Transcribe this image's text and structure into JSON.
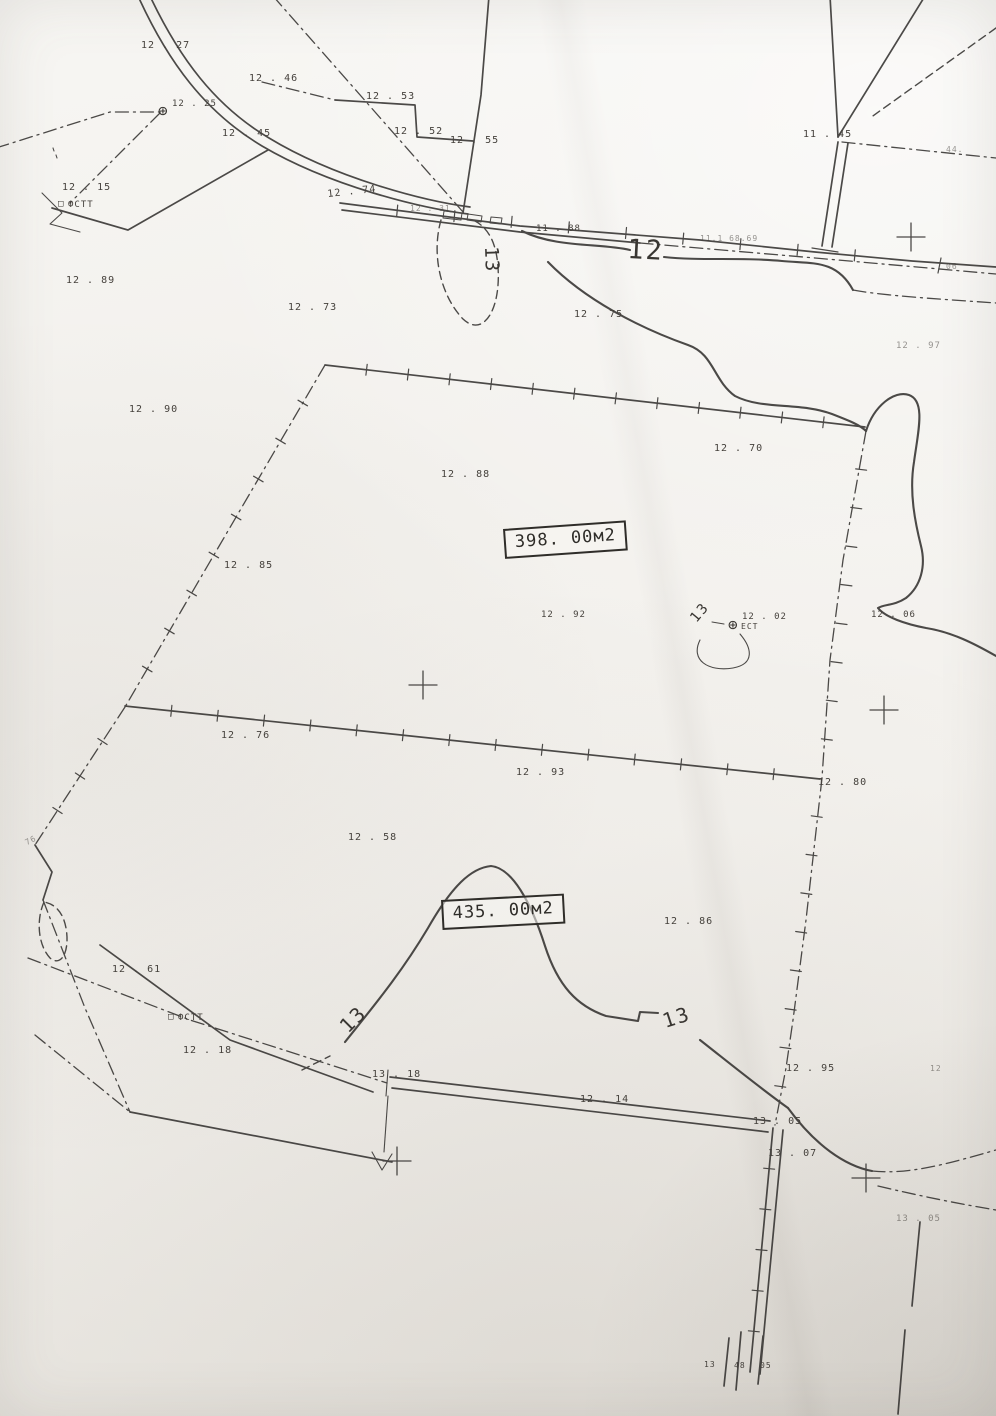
{
  "map": {
    "parcel_boxes": [
      {
        "label": "398. 00м2",
        "x": 503,
        "y": 529,
        "rot": -4
      },
      {
        "label": "435. 00м2",
        "x": 441,
        "y": 900,
        "rot": -3
      }
    ],
    "contour_labels": [
      {
        "text": "12",
        "x": 628,
        "y": 236,
        "size": 27,
        "rot": 3
      },
      {
        "text": "13",
        "x": 500,
        "y": 246,
        "size": 19,
        "rot": 88
      },
      {
        "text": "13",
        "x": 688,
        "y": 616,
        "size": 14,
        "rot": -50
      },
      {
        "text": "13",
        "x": 336,
        "y": 1022,
        "size": 20,
        "rot": -45
      },
      {
        "text": "13",
        "x": 660,
        "y": 1012,
        "size": 20,
        "rot": -18
      }
    ],
    "spot_elevations": [
      {
        "text": "12 . 27",
        "x": 141,
        "y": 41
      },
      {
        "text": "12 . 46",
        "x": 249,
        "y": 74
      },
      {
        "text": "12 . 25",
        "x": 172,
        "y": 100,
        "size": 9
      },
      {
        "text": "12 . 45",
        "x": 222,
        "y": 129
      },
      {
        "text": "12 . 15",
        "x": 62,
        "y": 183
      },
      {
        "text": "12 . 74",
        "x": 327,
        "y": 190,
        "rot": -6
      },
      {
        "text": "12 . 53",
        "x": 366,
        "y": 92
      },
      {
        "text": "12 . 52",
        "x": 394,
        "y": 127
      },
      {
        "text": "12 . 55",
        "x": 450,
        "y": 136
      },
      {
        "text": "12 . 31",
        "x": 410,
        "y": 205,
        "size": 8,
        "faint": true
      },
      {
        "text": "11 . 88",
        "x": 536,
        "y": 225,
        "size": 9
      },
      {
        "text": "11.1 68.69",
        "x": 700,
        "y": 235,
        "size": 8,
        "faint": true
      },
      {
        "text": "11 . 45",
        "x": 803,
        "y": 130
      },
      {
        "text": "44.",
        "x": 946,
        "y": 146,
        "size": 8,
        "faint": true
      },
      {
        "text": "06",
        "x": 946,
        "y": 263,
        "size": 8,
        "faint": true
      },
      {
        "text": "12 . 89",
        "x": 66,
        "y": 276
      },
      {
        "text": "12 . 73",
        "x": 288,
        "y": 303
      },
      {
        "text": "12 . 75",
        "x": 574,
        "y": 310
      },
      {
        "text": "12 . 97",
        "x": 896,
        "y": 342,
        "size": 9,
        "faint": true
      },
      {
        "text": "12 . 90",
        "x": 129,
        "y": 405
      },
      {
        "text": "12 . 88",
        "x": 441,
        "y": 470
      },
      {
        "text": "12 . 70",
        "x": 714,
        "y": 444
      },
      {
        "text": "12 . 85",
        "x": 224,
        "y": 561
      },
      {
        "text": "12 . 92",
        "x": 541,
        "y": 611,
        "size": 9
      },
      {
        "text": "12 . 06",
        "x": 871,
        "y": 611,
        "size": 9
      },
      {
        "text": "12 . 76",
        "x": 221,
        "y": 731
      },
      {
        "text": "12 . 93",
        "x": 516,
        "y": 768
      },
      {
        "text": "12 . 80",
        "x": 818,
        "y": 778
      },
      {
        "text": "12 . 58",
        "x": 348,
        "y": 833
      },
      {
        "text": "76",
        "x": 24,
        "y": 840,
        "size": 8,
        "rot": -28,
        "faint": true
      },
      {
        "text": "12 . 86",
        "x": 664,
        "y": 917
      },
      {
        "text": "12 . 61",
        "x": 112,
        "y": 965
      },
      {
        "text": "12 . 18",
        "x": 183,
        "y": 1046
      },
      {
        "text": "13 . 18",
        "x": 372,
        "y": 1070
      },
      {
        "text": "12 . 14",
        "x": 580,
        "y": 1095
      },
      {
        "text": "13 . 05",
        "x": 753,
        "y": 1117
      },
      {
        "text": "12 . 95",
        "x": 786,
        "y": 1064
      },
      {
        "text": "12",
        "x": 930,
        "y": 1065,
        "size": 8,
        "faint": true
      },
      {
        "text": "13 . 07",
        "x": 768,
        "y": 1149
      },
      {
        "text": "13 . 05",
        "x": 896,
        "y": 1215,
        "size": 9,
        "faint": true
      },
      {
        "text": "13",
        "x": 704,
        "y": 1361,
        "size": 8
      },
      {
        "text": "48",
        "x": 734,
        "y": 1362,
        "size": 8
      },
      {
        "text": "05",
        "x": 760,
        "y": 1362,
        "size": 8
      }
    ],
    "markers": [
      {
        "type": "circle-cross",
        "x": 158,
        "y": 103
      },
      {
        "type": "circle-cross",
        "x": 728,
        "y": 617,
        "label_top": "12 . 02",
        "label_bottom": "ЕСТ"
      },
      {
        "type": "square",
        "x": 58,
        "y": 200,
        "label": "ФСТТ"
      },
      {
        "type": "square",
        "x": 168,
        "y": 1013,
        "label": "ФСТТ"
      }
    ],
    "crosses": [
      {
        "x": 911,
        "y": 237
      },
      {
        "x": 423,
        "y": 685
      },
      {
        "x": 884,
        "y": 710
      },
      {
        "x": 397,
        "y": 1161
      },
      {
        "x": 866,
        "y": 1178
      }
    ]
  }
}
